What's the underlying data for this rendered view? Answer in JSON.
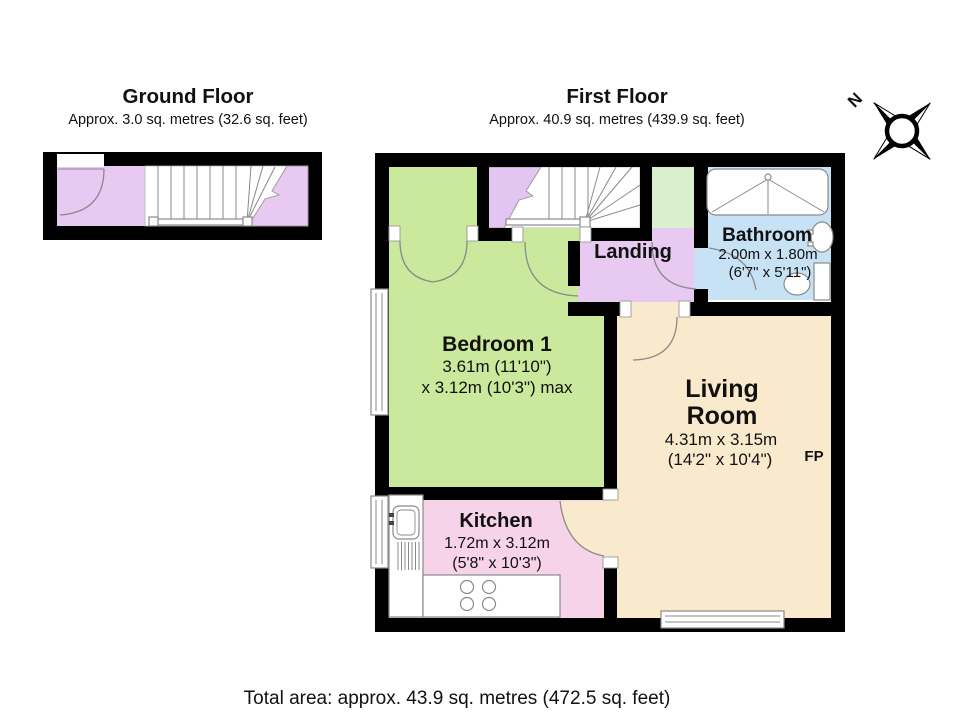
{
  "ground_floor": {
    "title": "Ground Floor",
    "area_label": "Approx. 3.0 sq. metres (32.6 sq. feet)"
  },
  "first_floor": {
    "title": "First Floor",
    "area_label": "Approx. 40.9 sq. metres (439.9 sq. feet)"
  },
  "compass": {
    "north_label": "N"
  },
  "rooms": {
    "bedroom": {
      "name": "Bedroom 1",
      "dim_metric": "3.61m (11'10\")",
      "dim_imperial": "x 3.12m (10'3\") max"
    },
    "landing": {
      "name": "Landing"
    },
    "bathroom": {
      "name": "Bathroom",
      "dim_metric": "2.00m x 1.80m",
      "dim_imperial": "(6'7\" x 5'11\")"
    },
    "living_room": {
      "name_line_1": "Living",
      "name_line_2": "Room",
      "dim_metric": "4.31m x 3.15m",
      "dim_imperial": "(14'2\" x 10'4\")",
      "fireplace_label": "FP"
    },
    "kitchen": {
      "name": "Kitchen",
      "dim_metric": "1.72m x 3.12m",
      "dim_imperial": "(5'8\" x 10'3\")"
    }
  },
  "footer": {
    "total_area": "Total area: approx. 43.9 sq. metres (472.5 sq. feet)"
  },
  "colors": {
    "wall": "#000000",
    "hall_purple": "#e7c9f2",
    "stairs_purple": "#e2c5f0",
    "bedroom_green": "#cbe99c",
    "closet_green": "#d9efcd",
    "bathroom_blue": "#c8e2f5",
    "living_cream": "#faeacd",
    "kitchen_pink": "#f6d3e9",
    "fixture_line": "#8a8a8a"
  }
}
